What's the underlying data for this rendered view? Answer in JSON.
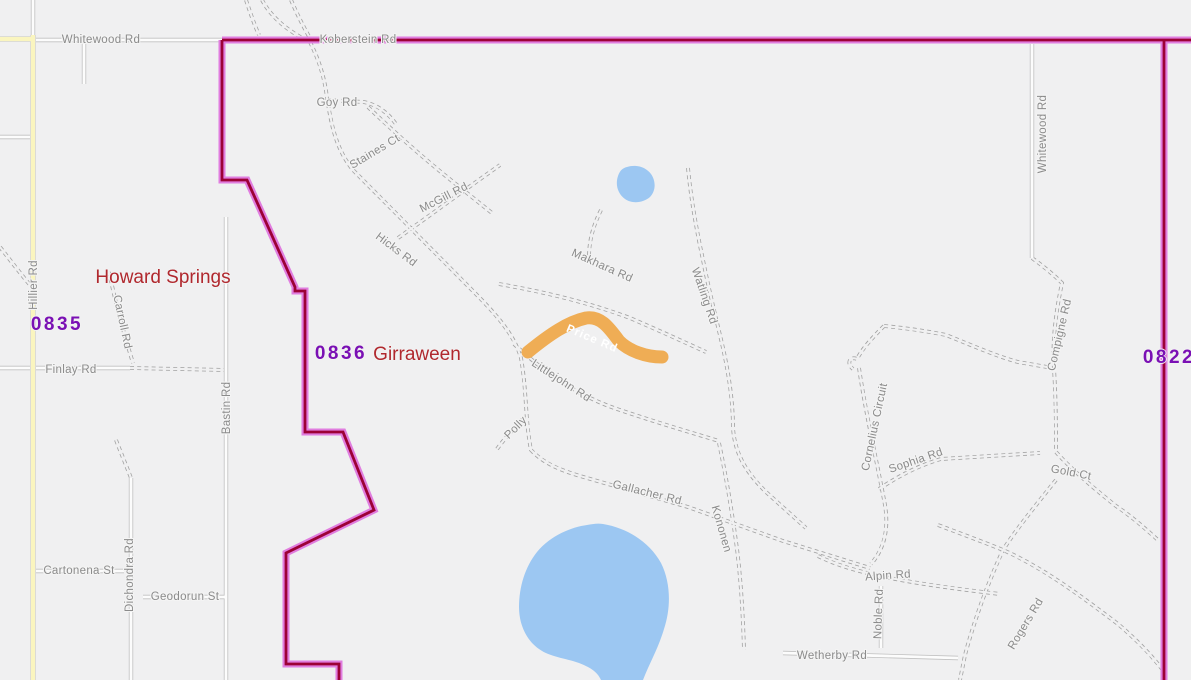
{
  "map": {
    "type": "street-map",
    "background_color": "#f0f0f1",
    "water_color": "#9cc7f2",
    "road_label_color": "#8b8b8b",
    "locality_label_color": "#b0282e",
    "postcode_label_color": "#7a10b4",
    "yellow_road_color": "#faf5bf",
    "boundary": {
      "outer_color": "#e07ddf",
      "inner_color": "#9c0136"
    },
    "highlighted_road": {
      "label": "Price Rd",
      "color": "#efad55",
      "text_color": "#ffffff"
    },
    "localities": [
      {
        "name": "Howard Springs"
      },
      {
        "name": "Girraween"
      }
    ],
    "postcodes": [
      {
        "code": "0835"
      },
      {
        "code": "0836"
      },
      {
        "code": "0822"
      }
    ],
    "road_labels": [
      {
        "text": "Whitewood Rd"
      },
      {
        "text": "Koberstein Rd"
      },
      {
        "text": "Goy Rd"
      },
      {
        "text": "Staines Ct"
      },
      {
        "text": "McGill Rd"
      },
      {
        "text": "Hicks Rd"
      },
      {
        "text": "Makhara Rd"
      },
      {
        "text": "Watling Rd"
      },
      {
        "text": "Littlejohn Rd"
      },
      {
        "text": "Polly"
      },
      {
        "text": "Gallacher Rd"
      },
      {
        "text": "Kononen"
      },
      {
        "text": "Cornelius Circuit"
      },
      {
        "text": "Sophia Rd"
      },
      {
        "text": "Gold Ct"
      },
      {
        "text": "Compigne Rd"
      },
      {
        "text": "Whitewood Rd"
      },
      {
        "text": "Alpin Rd"
      },
      {
        "text": "Noble Rd"
      },
      {
        "text": "Wetherby Rd"
      },
      {
        "text": "Rogers Rd"
      },
      {
        "text": "Hillier Rd"
      },
      {
        "text": "Carroll Rd"
      },
      {
        "text": "Finlay Rd"
      },
      {
        "text": "Bastin Rd"
      },
      {
        "text": "Cartonena St"
      },
      {
        "text": "Dichondra Rd"
      },
      {
        "text": "Geodorun St"
      }
    ],
    "water_features": [
      {
        "name": "pond"
      },
      {
        "name": "lake"
      }
    ]
  }
}
